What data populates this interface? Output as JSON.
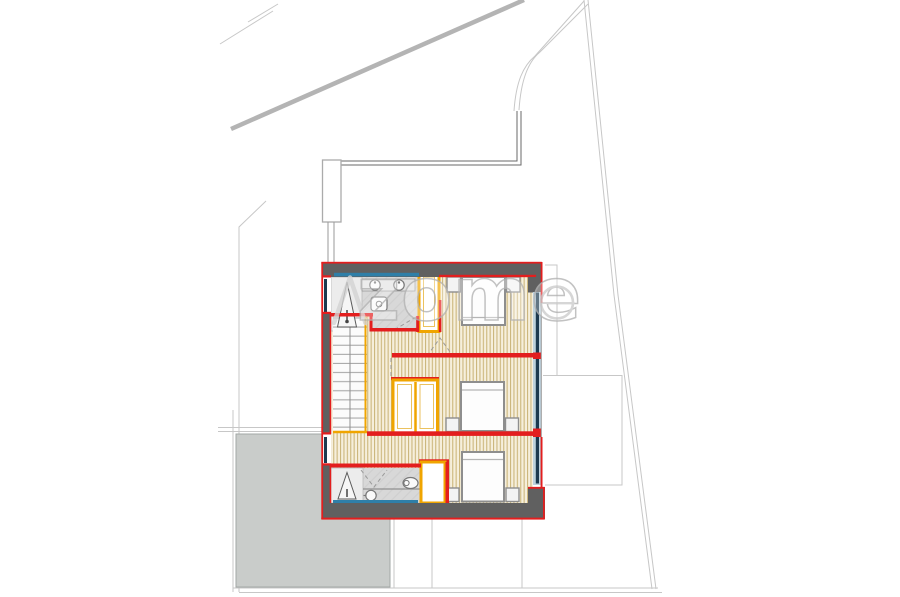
{
  "watermark": {
    "text": "zome",
    "mark": "caret-A",
    "registered_symbol": "circled-mark"
  },
  "palette": {
    "background": "#ffffff",
    "wall_fill": "#606060",
    "wall_outline_red": "#e31e1e",
    "carpentry_yellow": "#f0a500",
    "wood_floor_light": "#f6efdc",
    "wood_floor_stripe": "#ccb67c",
    "bathroom_floor_gray": "#d8d8d8",
    "window_glass_navy": "#1c3a4f",
    "window_frame_blue": "#2f7fa8",
    "window_fill_light_blue": "#bdd2dd",
    "terrace_gray": "#c9ccca",
    "site_line_gray": "#c7c7c7",
    "furniture_outline": "#8e8e8e"
  },
  "plan_inventory": {
    "beds": 3,
    "nightstands": 6,
    "bathrooms": 2,
    "showers": 2,
    "washbasins": 3,
    "toilets": 2,
    "wardrobe_units": 4,
    "staircases": 1
  }
}
